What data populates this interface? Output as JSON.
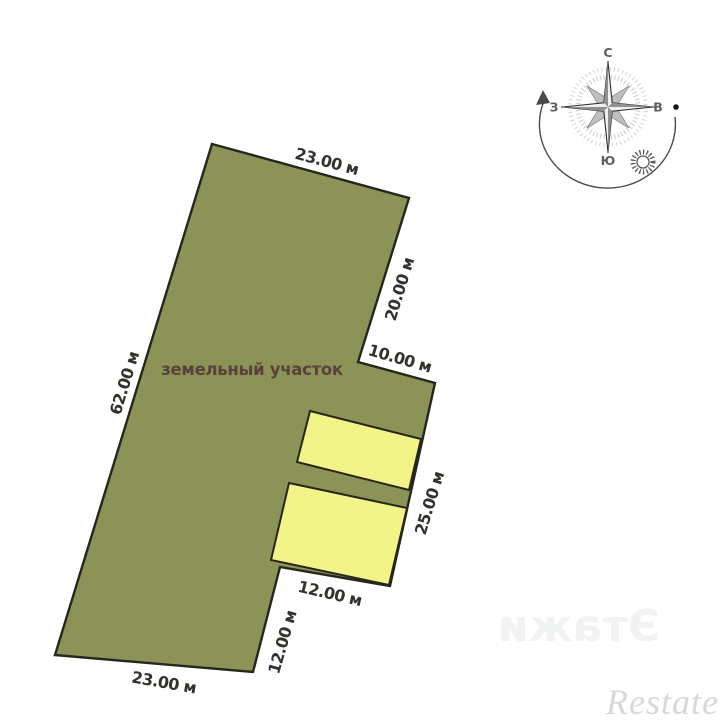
{
  "plot": {
    "label": "земельный участок",
    "dimensions": {
      "top_edge": "23.00 м",
      "upper_right_edge": "20.00 м",
      "step_edge": "10.00 м",
      "left_edge": "62.00 м",
      "lower_right_edge": "25.00 м",
      "buildings_bottom_edge": "12.00 м",
      "notch_side_edge": "12.00 м",
      "bottom_edge": "23.00 м"
    }
  },
  "compass": {
    "north_label": "С",
    "south_label": "Ю",
    "west_label": "З",
    "east_label": "В"
  },
  "watermarks": {
    "center_logo": "etag",
    "mirrored_text": "Этажи",
    "bottom_right_logo": "Restate"
  },
  "colors": {
    "plot_fill": "#8c9357",
    "building_fill": "#f3f487",
    "outline": "#26261c",
    "dimension_text": "#33332e",
    "plot_label_text": "#5a413c",
    "compass_text": "#5f5f5f",
    "watermark_light_gray": "#d8d8d8"
  }
}
